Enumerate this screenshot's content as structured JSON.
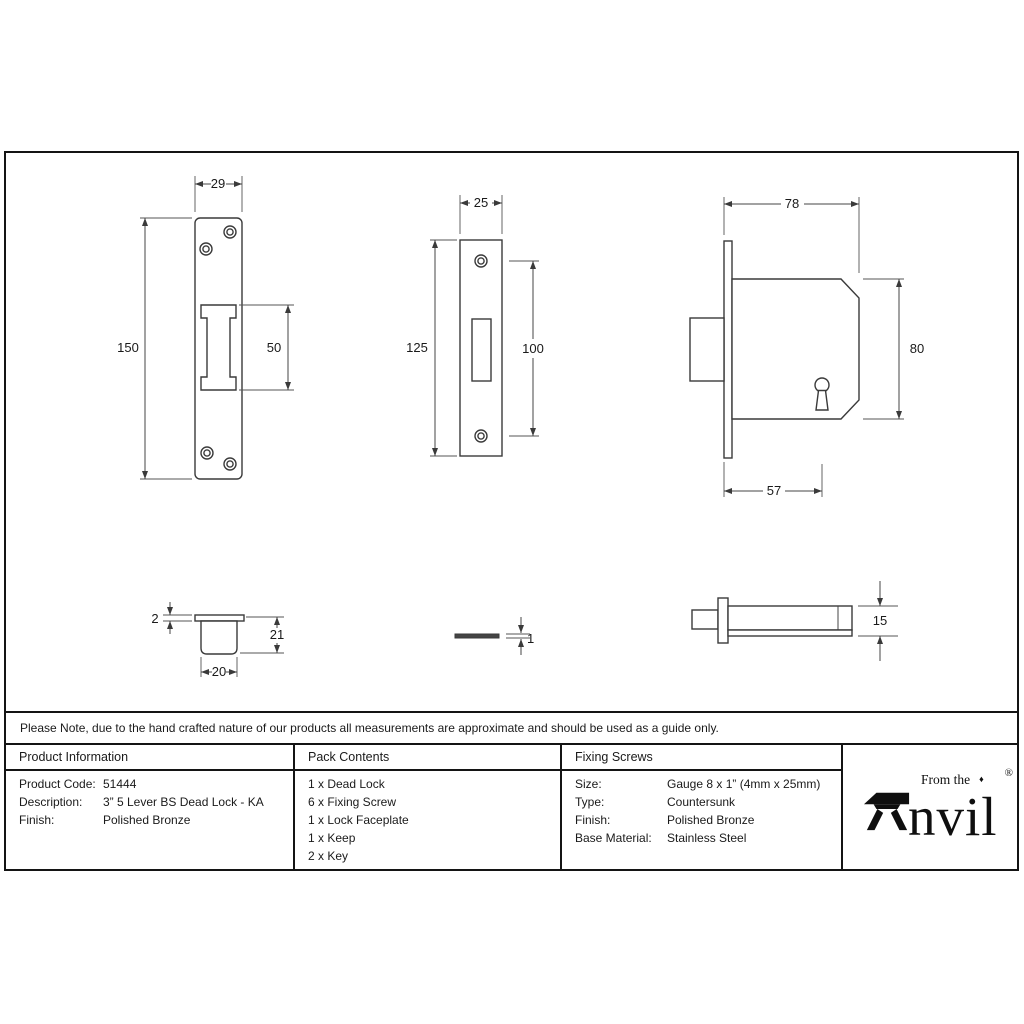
{
  "colors": {
    "background": "#ffffff",
    "drawing_line": "#3a3a3a",
    "border": "#141414",
    "text": "#1a1a1a"
  },
  "note": "Please Note, due to the hand crafted nature of our products all measurements are approximate and should be used as a guide only.",
  "drawings": {
    "keep_front_view": {
      "width_mm": "29",
      "height_mm": "150",
      "cutout_height_mm": "50"
    },
    "faceplate_front_view": {
      "width_mm": "25",
      "height_mm": "125",
      "screw_centres_mm": "100"
    },
    "lock_body_side_view": {
      "depth_mm": "78",
      "height_mm": "80",
      "backset_mm": "57"
    },
    "keep_profile_view": {
      "plate_thickness_mm": "2",
      "box_depth_mm": "21",
      "box_width_mm": "20"
    },
    "faceplate_profile_view": {
      "thickness_mm": "1"
    },
    "bolt_profile_view": {
      "height_mm": "15"
    }
  },
  "table": {
    "product_information": {
      "header": "Product Information",
      "rows": [
        {
          "label": "Product Code:",
          "value": "51444"
        },
        {
          "label": "Description:",
          "value": "3” 5 Lever BS Dead Lock - KA"
        },
        {
          "label": "Finish:",
          "value": "Polished Bronze"
        }
      ]
    },
    "pack_contents": {
      "header": "Pack Contents",
      "items": [
        "1 x Dead Lock",
        "6 x Fixing Screw",
        "1 x Lock Faceplate",
        "1 x Keep",
        "2 x Key"
      ]
    },
    "fixing_screws": {
      "header": "Fixing Screws",
      "rows": [
        {
          "label": "Size:",
          "value": "Gauge 8 x 1” (4mm x 25mm)"
        },
        {
          "label": "Type:",
          "value": "Countersunk"
        },
        {
          "label": "Finish:",
          "value": "Polished Bronze"
        },
        {
          "label": "Base Material:",
          "value": "Stainless Steel"
        }
      ]
    }
  },
  "logo": {
    "pre_text": "From the",
    "diamond": "♦",
    "brand_initial": "A",
    "brand_rest": "nvil",
    "registered": "®"
  }
}
